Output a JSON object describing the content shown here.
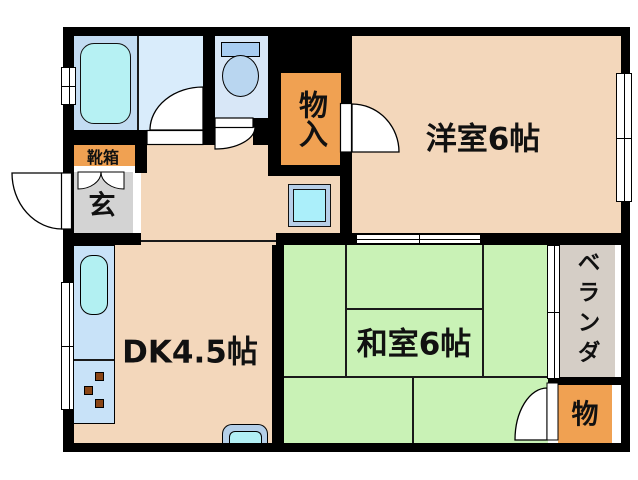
{
  "floorplan": {
    "type": "apartment-floor-plan",
    "rooms": {
      "western_room": {
        "label": "洋室6帖"
      },
      "japanese_room": {
        "label": "和室6帖"
      },
      "dining_kitchen": {
        "label": "DK4.5帖"
      },
      "hall_closet": {
        "label": "物入"
      },
      "shoe_cabinet": {
        "label": "靴箱"
      },
      "entrance": {
        "label": "玄"
      },
      "veranda": {
        "label": "ベランダ"
      },
      "tatami_closet": {
        "label": "物"
      }
    },
    "colors": {
      "wall": "#000000",
      "floor_peach": "#f3d7bb",
      "tatami_green": "#c9f2b6",
      "closet_orange": "#f0a152",
      "entrance_gray": "#d3d3d3",
      "veranda_gray": "#d5cec6",
      "bath_blue": "#c3dcf2",
      "washroom_blue": "#d9ecfb",
      "toilet_blue": "#d8e7f7",
      "fixture_cyan": "#b2f0f2",
      "counter_blue": "#c8e2f8",
      "appliance_blue": "#b7cfe8"
    }
  }
}
